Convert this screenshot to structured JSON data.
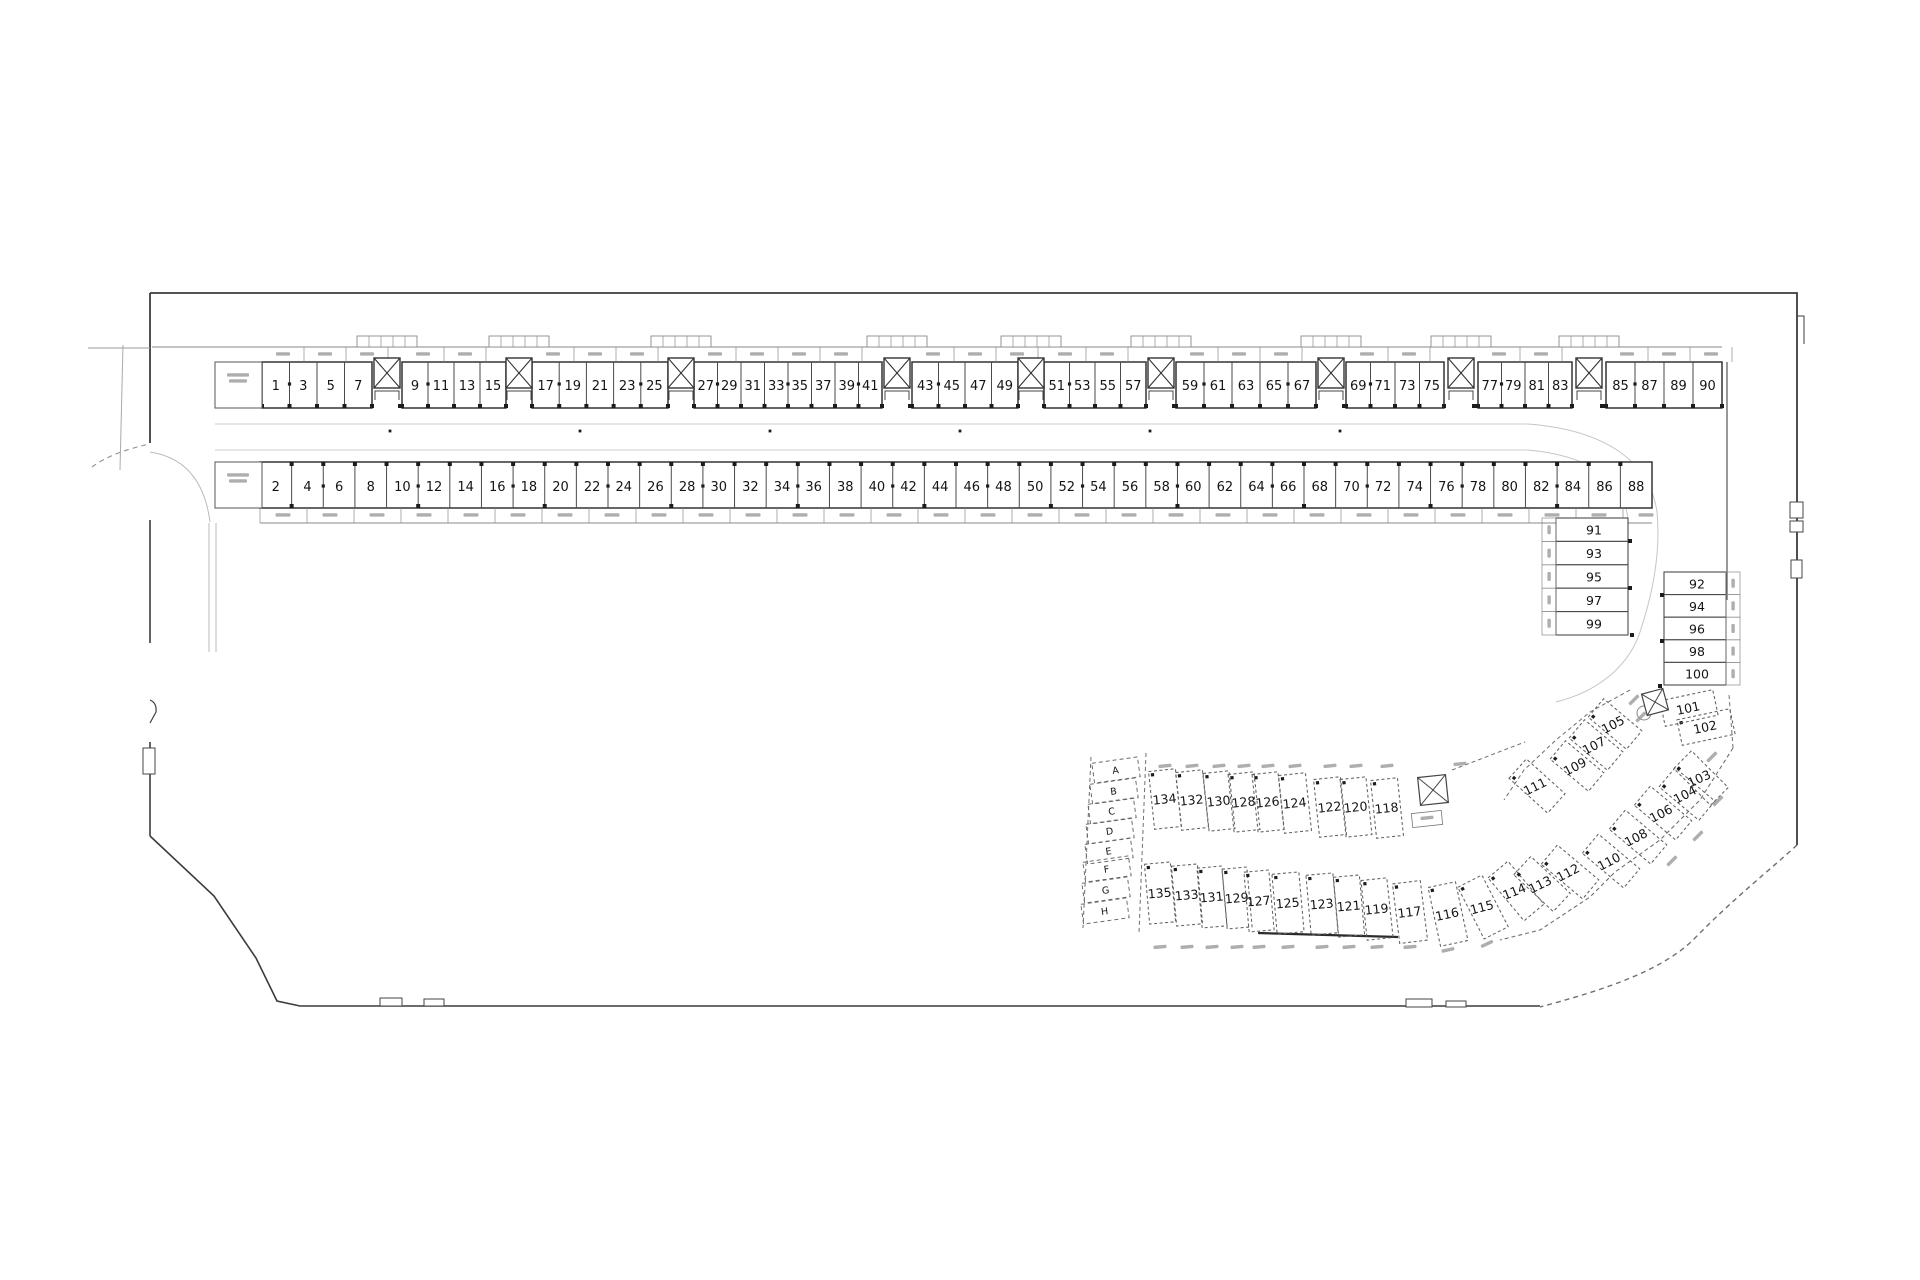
{
  "plan": {
    "colors": {
      "wall": "#3c3c3c",
      "stall_line": "#4a4a4a",
      "thin": "#8a8a8a",
      "light": "#c6c6c6",
      "dash": "#616161",
      "text": "#141414",
      "smudge": "#a0a0a0"
    },
    "row_top": {
      "y": 362,
      "h": 46,
      "strip_y": 347,
      "segments": [
        {
          "x0": 262,
          "x1": 372,
          "stalls": [
            "1",
            "3",
            "5",
            "7"
          ]
        },
        {
          "x0": 402,
          "x1": 506,
          "stalls": [
            "9",
            "11",
            "13",
            "15"
          ]
        },
        {
          "x0": 532,
          "x1": 668,
          "stalls": [
            "17",
            "19",
            "21",
            "23",
            "25"
          ]
        },
        {
          "x0": 694,
          "x1": 882,
          "stalls": [
            "27",
            "29",
            "31",
            "33",
            "35",
            "37",
            "39",
            "41"
          ]
        },
        {
          "x0": 912,
          "x1": 1018,
          "stalls": [
            "43",
            "45",
            "47",
            "49"
          ]
        },
        {
          "x0": 1044,
          "x1": 1146,
          "stalls": [
            "51",
            "53",
            "55",
            "57"
          ]
        },
        {
          "x0": 1176,
          "x1": 1316,
          "stalls": [
            "59",
            "61",
            "63",
            "65",
            "67"
          ]
        },
        {
          "x0": 1346,
          "x1": 1444,
          "stalls": [
            "69",
            "71",
            "73",
            "75"
          ]
        },
        {
          "x0": 1478,
          "x1": 1572,
          "stalls": [
            "77",
            "79",
            "81",
            "83"
          ]
        },
        {
          "x0": 1606,
          "x1": 1722,
          "stalls": [
            "85",
            "87",
            "89",
            "90"
          ]
        }
      ],
      "cores": [
        387,
        519,
        681,
        897,
        1031,
        1161,
        1331,
        1461,
        1589
      ]
    },
    "row_bottom": {
      "x0": 260,
      "x1": 1652,
      "y": 462,
      "h": 46,
      "stalls": [
        "2",
        "4",
        "6",
        "8",
        "10",
        "12",
        "14",
        "16",
        "18",
        "20",
        "22",
        "24",
        "26",
        "28",
        "30",
        "32",
        "34",
        "36",
        "38",
        "40",
        "42",
        "44",
        "46",
        "48",
        "50",
        "52",
        "54",
        "56",
        "58",
        "60",
        "62",
        "64",
        "66",
        "68",
        "70",
        "72",
        "74",
        "76",
        "78",
        "80",
        "82",
        "84",
        "86",
        "88"
      ]
    },
    "col_left": {
      "x": 1556,
      "w": 72,
      "y0": 518,
      "rh": 23.4,
      "stalls": [
        "91",
        "93",
        "95",
        "97",
        "99"
      ]
    },
    "col_right": {
      "x": 1664,
      "w": 62,
      "y0": 572,
      "rh": 22.6,
      "stalls": [
        "92",
        "94",
        "96",
        "98",
        "100"
      ]
    },
    "cluster": {
      "letters": [
        {
          "t": "A",
          "x": 1116,
          "y": 770,
          "r": -8
        },
        {
          "t": "B",
          "x": 1114,
          "y": 791,
          "r": -8
        },
        {
          "t": "C",
          "x": 1112,
          "y": 811,
          "r": -8
        },
        {
          "t": "D",
          "x": 1110,
          "y": 831,
          "r": -8
        },
        {
          "t": "E",
          "x": 1109,
          "y": 851,
          "r": -8
        },
        {
          "t": "F",
          "x": 1107,
          "y": 869,
          "r": -8
        },
        {
          "t": "G",
          "x": 1106,
          "y": 890,
          "r": -8
        },
        {
          "t": "H",
          "x": 1105,
          "y": 911,
          "r": -8
        }
      ],
      "stalls": [
        {
          "n": "134",
          "x": 1165,
          "y": 799,
          "w": 27,
          "h": 58,
          "r": -6
        },
        {
          "n": "132",
          "x": 1192,
          "y": 800,
          "w": 27,
          "h": 58,
          "r": -6
        },
        {
          "n": "130",
          "x": 1219,
          "y": 801,
          "w": 26,
          "h": 58,
          "r": -6
        },
        {
          "n": "128",
          "x": 1244,
          "y": 802,
          "w": 26,
          "h": 58,
          "r": -6
        },
        {
          "n": "126",
          "x": 1268,
          "y": 802,
          "w": 26,
          "h": 58,
          "r": -6
        },
        {
          "n": "124",
          "x": 1295,
          "y": 803,
          "w": 27,
          "h": 58,
          "r": -6
        },
        {
          "n": "122",
          "x": 1330,
          "y": 807,
          "w": 27,
          "h": 58,
          "r": -6
        },
        {
          "n": "120",
          "x": 1356,
          "y": 807,
          "w": 26,
          "h": 58,
          "r": -6
        },
        {
          "n": "118",
          "x": 1387,
          "y": 808,
          "w": 27,
          "h": 58,
          "r": -6
        },
        {
          "n": "135",
          "x": 1160,
          "y": 893,
          "w": 26,
          "h": 60,
          "r": -5
        },
        {
          "n": "133",
          "x": 1187,
          "y": 895,
          "w": 26,
          "h": 60,
          "r": -5
        },
        {
          "n": "131",
          "x": 1212,
          "y": 897,
          "w": 25,
          "h": 60,
          "r": -5
        },
        {
          "n": "129",
          "x": 1237,
          "y": 898,
          "w": 25,
          "h": 60,
          "r": -5
        },
        {
          "n": "127",
          "x": 1259,
          "y": 901,
          "w": 25,
          "h": 60,
          "r": -5
        },
        {
          "n": "125",
          "x": 1288,
          "y": 903,
          "w": 27,
          "h": 60,
          "r": -5
        },
        {
          "n": "123",
          "x": 1322,
          "y": 904,
          "w": 27,
          "h": 60,
          "r": -5
        },
        {
          "n": "121",
          "x": 1349,
          "y": 906,
          "w": 26,
          "h": 60,
          "r": -5
        },
        {
          "n": "119",
          "x": 1377,
          "y": 909,
          "w": 26,
          "h": 60,
          "r": -6
        },
        {
          "n": "117",
          "x": 1410,
          "y": 912,
          "w": 28,
          "h": 60,
          "r": -7
        },
        {
          "n": "116",
          "x": 1448,
          "y": 914,
          "w": 28,
          "h": 60,
          "r": -12
        },
        {
          "n": "115",
          "x": 1483,
          "y": 907,
          "w": 27,
          "h": 58,
          "r": -27
        },
        {
          "n": "114",
          "x": 1516,
          "y": 891,
          "w": 26,
          "h": 56,
          "r": -40
        },
        {
          "n": "113",
          "x": 1542,
          "y": 884,
          "w": 25,
          "h": 54,
          "r": -47
        },
        {
          "n": "112",
          "x": 1570,
          "y": 872,
          "w": 25,
          "h": 54,
          "r": -50
        },
        {
          "n": "110",
          "x": 1611,
          "y": 861,
          "w": 25,
          "h": 54,
          "r": -50
        },
        {
          "n": "108",
          "x": 1638,
          "y": 837,
          "w": 25,
          "h": 54,
          "r": -50
        },
        {
          "n": "106",
          "x": 1663,
          "y": 813,
          "w": 25,
          "h": 54,
          "r": -50
        },
        {
          "n": "104",
          "x": 1687,
          "y": 794,
          "w": 25,
          "h": 52,
          "r": -50
        },
        {
          "n": "103",
          "x": 1701,
          "y": 778,
          "w": 25,
          "h": 52,
          "r": -45
        },
        {
          "n": "102",
          "x": 1706,
          "y": 727,
          "w": 54,
          "h": 26,
          "r": -12
        },
        {
          "n": "101",
          "x": 1689,
          "y": 708,
          "w": 54,
          "h": 26,
          "r": -12
        },
        {
          "n": "105",
          "x": 1615,
          "y": 724,
          "w": 24,
          "h": 50,
          "r": -50
        },
        {
          "n": "107",
          "x": 1596,
          "y": 745,
          "w": 24,
          "h": 50,
          "r": -50
        },
        {
          "n": "109",
          "x": 1577,
          "y": 766,
          "w": 24,
          "h": 50,
          "r": -50
        },
        {
          "n": "111",
          "x": 1537,
          "y": 786,
          "w": 26,
          "h": 52,
          "r": -48
        }
      ],
      "xboxes": [
        {
          "x": 1433,
          "y": 790,
          "w": 28,
          "h": 28,
          "r": -6
        },
        {
          "x": 1655,
          "y": 702,
          "w": 22,
          "h": 22,
          "r": -15
        }
      ],
      "smudges": [
        {
          "x": 1712,
          "y": 757,
          "r": -45
        },
        {
          "x": 1718,
          "y": 801,
          "r": -45
        },
        {
          "x": 1698,
          "y": 836,
          "r": -45
        },
        {
          "x": 1672,
          "y": 861,
          "r": -45
        },
        {
          "x": 1634,
          "y": 700,
          "r": -45
        },
        {
          "x": 1641,
          "y": 717,
          "r": -45
        },
        {
          "x": 1427,
          "y": 818,
          "r": -6
        },
        {
          "x": 1460,
          "y": 764,
          "r": -6
        },
        {
          "x": 1487,
          "y": 944,
          "r": -25
        },
        {
          "x": 1448,
          "y": 950,
          "r": -12
        }
      ]
    },
    "rooms": [
      {
        "x": 215,
        "y": 362,
        "w": 47,
        "h": 46
      },
      {
        "x": 215,
        "y": 462,
        "w": 47,
        "h": 46
      }
    ]
  }
}
